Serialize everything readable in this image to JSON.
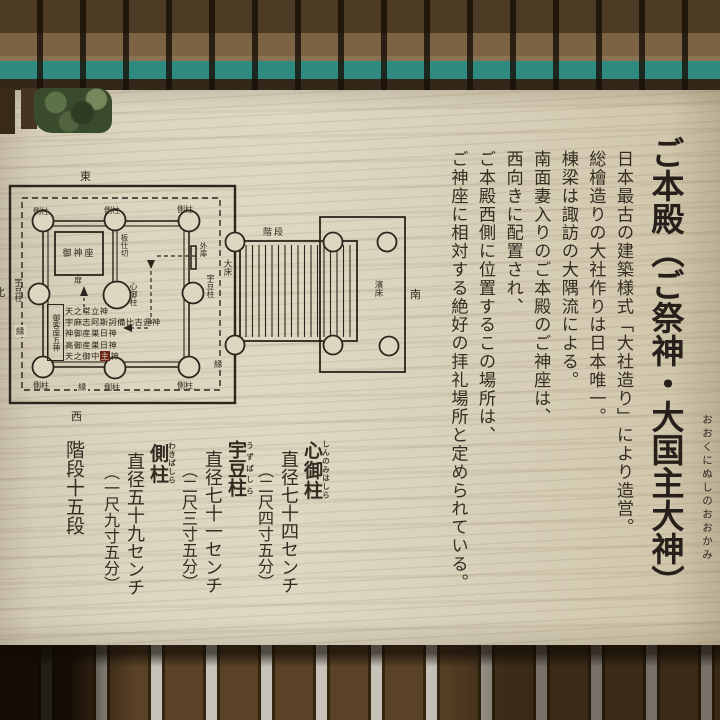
{
  "sign": {
    "title": "ご本殿（ご祭神・大国主大神）",
    "title_furigana": "おおくにぬしのおおかみ",
    "body_lines": [
      "日本最古の建築様式「大社造り」により造営。",
      "総檜造りの大社作りは日本唯一。",
      "棟梁は諏訪の大隅流による。",
      "南面妻入りのご本殿のご神座は、",
      "西向きに配置され、",
      "ご本殿西側に位置するこの場所は、",
      "ご神座に相対する絶好の拝礼場所と定められている。"
    ],
    "measurements": [
      {
        "name": "心御柱",
        "furigana": "しんのみはしら",
        "diameter": "直径七十四センチ",
        "shaku": "（二尺四寸五分）"
      },
      {
        "name": "宇豆柱",
        "furigana": "うずばしら",
        "diameter": "直径七十一センチ",
        "shaku": "（二尺三寸五分）"
      },
      {
        "name": "側柱",
        "furigana": "わきばしら",
        "diameter": "直径五十九センチ",
        "shaku": "（一尺九寸五分）"
      }
    ],
    "stairs": {
      "label": "階段",
      "value": "十五段"
    }
  },
  "diagram": {
    "directions": {
      "east": "東",
      "west": "西",
      "south": "南",
      "north": "北"
    },
    "labels": {
      "side_pillar": "側柱",
      "uzu_pillar": "宇豆柱",
      "heart_pillar": "心御柱",
      "seat": "御神座",
      "partition": "板仕切",
      "door": "外扉",
      "door_char": "扉",
      "stairs": "階段",
      "large_floor": "大床",
      "hama_floor": "濱床",
      "veranda": "縁",
      "guest_box": "御客座五神"
    },
    "deities": [
      "天之常立神",
      "宇麻志阿斯訶備比古遅神",
      "神御産巣日神",
      "高御産巣日神"
    ],
    "deity5": {
      "pre": "天之御中",
      "hl": "主",
      "post": "神"
    }
  }
}
